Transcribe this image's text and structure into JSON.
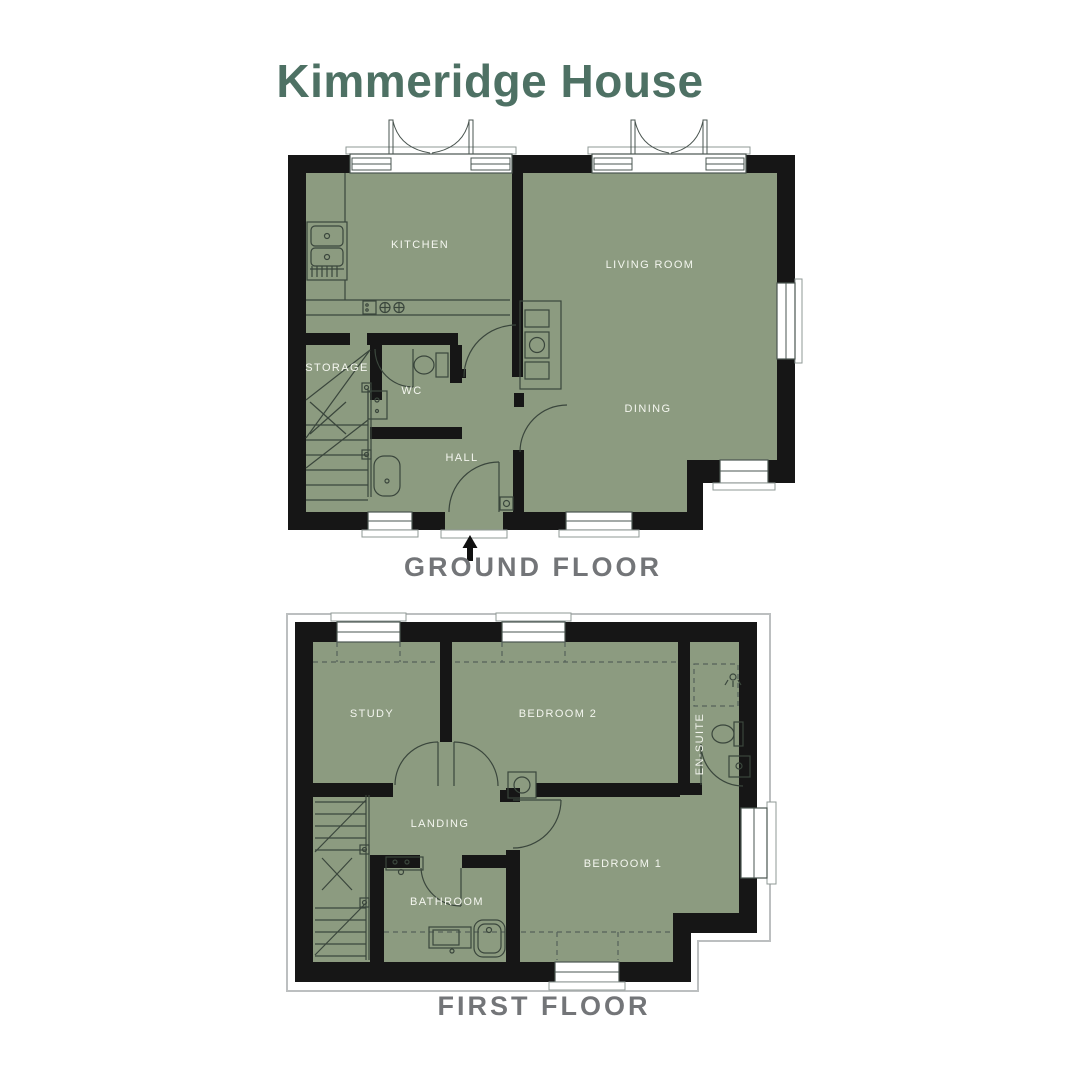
{
  "title": "Kimmeridge House",
  "colors": {
    "title_green": "#4e7164",
    "room_fill": "#8c9b80",
    "wall_black": "#161616",
    "caption_gray": "#737578",
    "label_white": "#f4f6ef",
    "fixture_line": "#3a463c",
    "footprint_outline": "#bcbfc0"
  },
  "icons": {
    "entrance_arrow": "up-arrow"
  },
  "floors": [
    {
      "name": "GROUND FLOOR",
      "rooms": [
        {
          "label": "KITCHEN"
        },
        {
          "label": "LIVING ROOM"
        },
        {
          "label": "STORAGE"
        },
        {
          "label": "WC"
        },
        {
          "label": "HALL"
        },
        {
          "label": "DINING"
        }
      ]
    },
    {
      "name": "FIRST FLOOR",
      "rooms": [
        {
          "label": "STUDY"
        },
        {
          "label": "BEDROOM 2"
        },
        {
          "label": "EN-SUITE"
        },
        {
          "label": "LANDING"
        },
        {
          "label": "BATHROOM"
        },
        {
          "label": "BEDROOM 1"
        }
      ]
    }
  ]
}
